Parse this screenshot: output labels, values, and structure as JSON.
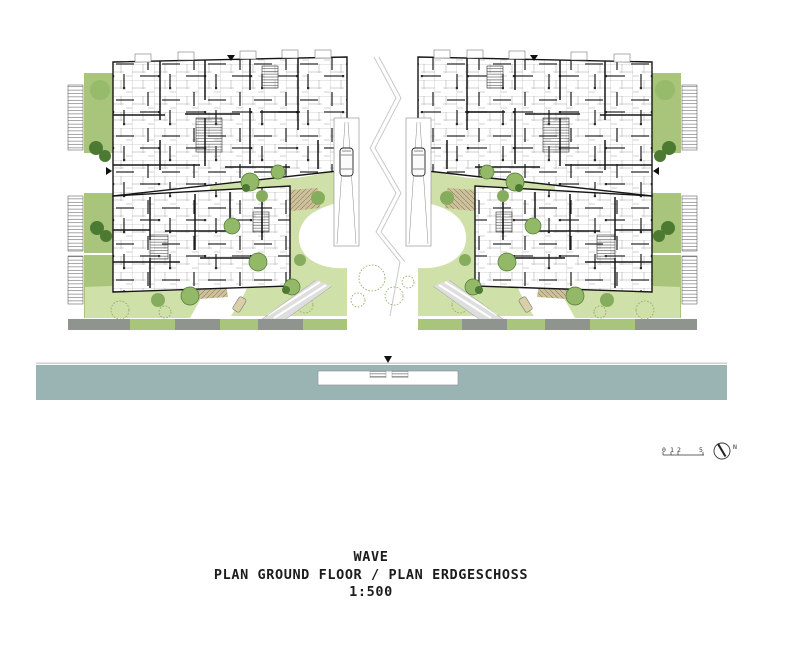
{
  "title_block": {
    "project_name": "WAVE",
    "plan_title": "PLAN GROUND FLOOR / PLAN ERDGESCHOSS",
    "scale": "1:500"
  },
  "scale_bar": {
    "labels": [
      "0",
      "1",
      "2",
      "5"
    ]
  },
  "compass": {
    "label": "N"
  },
  "colors": {
    "water": "#9ab3b3",
    "water_edge_line": "#cdcdcd",
    "lawn_light": "#cfe0a8",
    "green_strip": "#a9c57b",
    "tree_medium": "#93b868",
    "tree_dark": "#4c7a33",
    "terrace_tan": "#cdc29b",
    "road_gray": "#8f948e",
    "wall_black": "#161616",
    "sketch_line_gray": "#c9c9c9"
  }
}
